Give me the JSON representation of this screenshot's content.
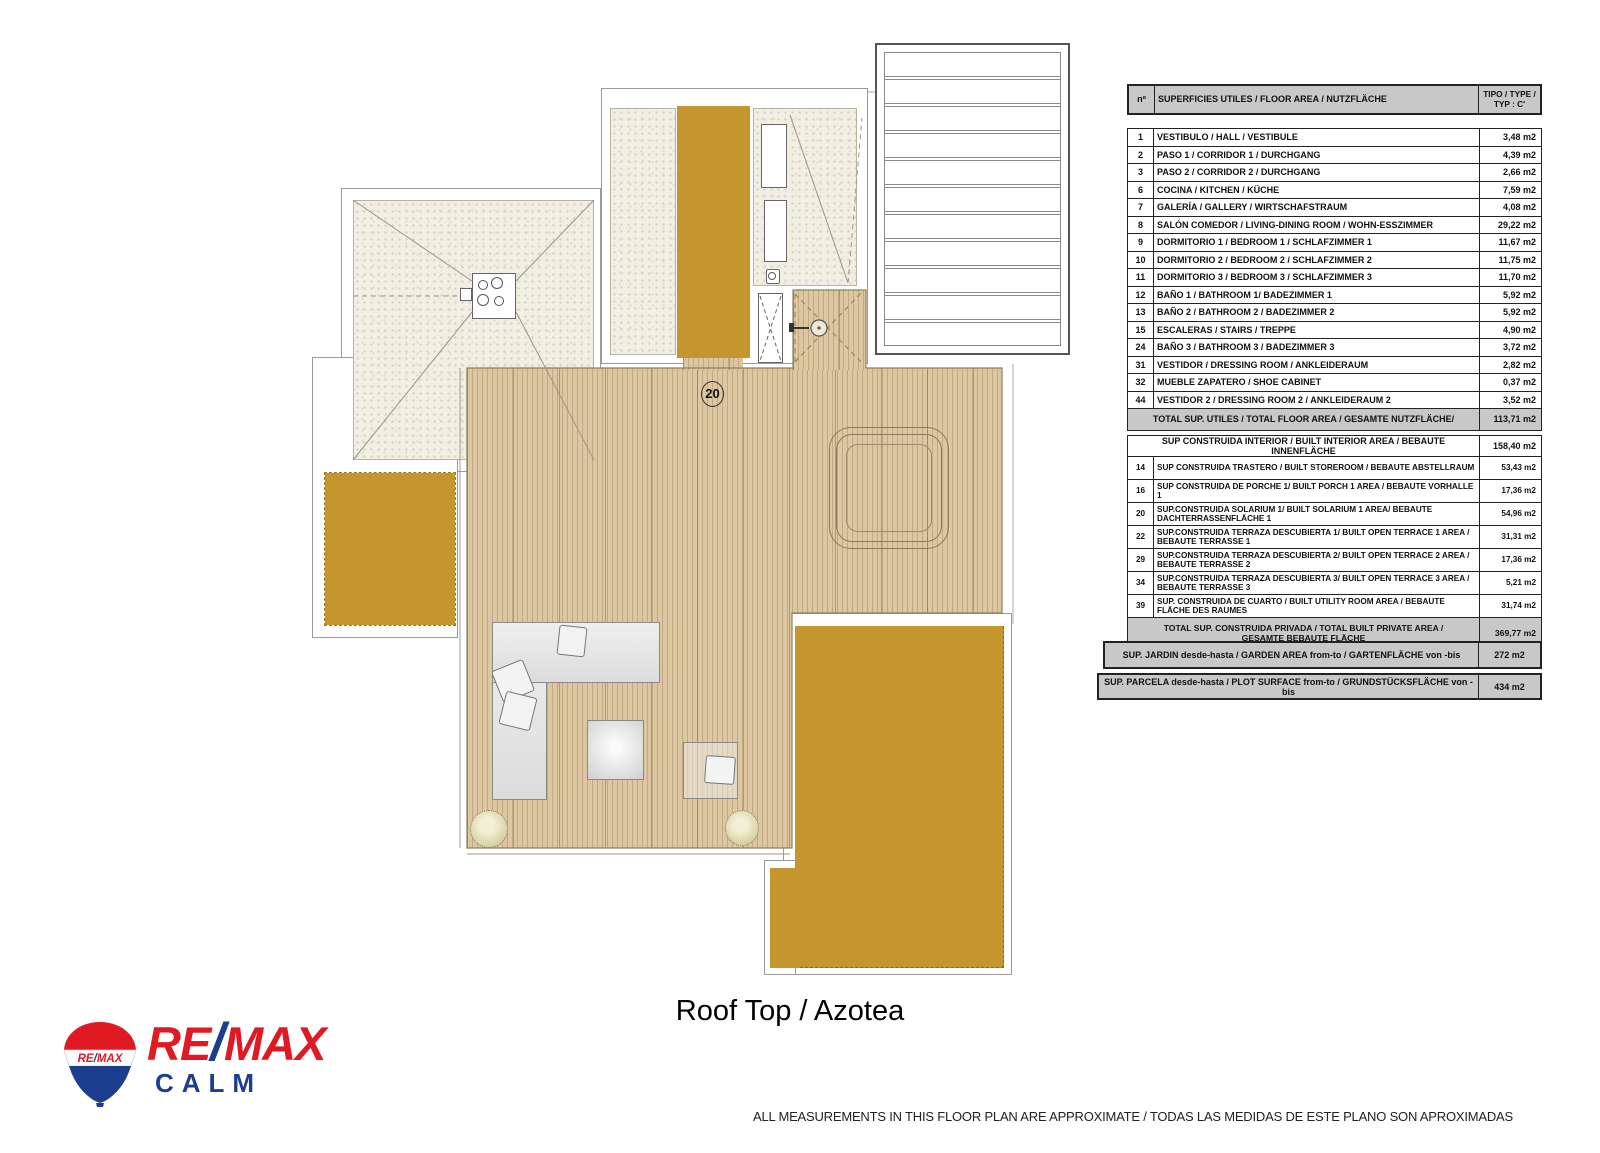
{
  "title": "Roof Top / Azotea",
  "disclaimer": "ALL MEASUREMENTS IN THIS FLOOR PLAN ARE APPROXIMATE / TODAS LAS MEDIDAS DE ESTE PLANO SON APROXIMADAS",
  "logo": {
    "balloon_text": "RE/MAX",
    "re": "RE",
    "slash": "/",
    "max": "MAX",
    "office": "CALM"
  },
  "plan": {
    "solarium_number": "20"
  },
  "colors": {
    "gold": "#c5962e",
    "wood": "#dcc7a2",
    "gravel": "#f1eee3",
    "table_grey": "#c8c8c8",
    "remax_red": "#e01a22",
    "remax_blue": "#1c3e8f"
  },
  "table": {
    "header": {
      "num": "nº",
      "label": "SUPERFICIES UTILES / FLOOR AREA / NUTZFLÄCHE",
      "type": "TIPO / TYPE / TYP : C'"
    },
    "rooms": [
      {
        "num": "1",
        "label": "VESTIBULO / HALL  / VESTIBULE",
        "value": "3,48 m2"
      },
      {
        "num": "2",
        "label": "PASO 1 / CORRIDOR 1 / DURCHGANG",
        "value": "4,39 m2"
      },
      {
        "num": "3",
        "label": "PASO 2 / CORRIDOR 2 / DURCHGANG",
        "value": "2,66 m2"
      },
      {
        "num": "6",
        "label": "COCINA / KITCHEN  / KÜCHE",
        "value": "7,59 m2"
      },
      {
        "num": "7",
        "label": "GALERÍA / GALLERY / WIRTSCHAFSTRAUM",
        "value": "4,08 m2"
      },
      {
        "num": "8",
        "label": "SALÓN COMEDOR  / LIVING-DINING ROOM / WOHN-ESSZIMMER",
        "value": "29,22 m2"
      },
      {
        "num": "9",
        "label": "DORMITORIO 1 / BEDROOM 1 / SCHLAFZIMMER 1",
        "value": "11,67 m2"
      },
      {
        "num": "10",
        "label": "DORMITORIO 2 / BEDROOM 2 / SCHLAFZIMMER 2",
        "value": "11,75 m2"
      },
      {
        "num": "11",
        "label": "DORMITORIO 3 / BEDROOM 3 / SCHLAFZIMMER 3",
        "value": "11,70 m2"
      },
      {
        "num": "12",
        "label": "BAÑO 1 / BATHROOM 1/ BADEZIMMER 1",
        "value": "5,92 m2"
      },
      {
        "num": "13",
        "label": "BAÑO 2 / BATHROOM 2 / BADEZIMMER 2",
        "value": "5,92 m2"
      },
      {
        "num": "15",
        "label": "ESCALERAS / STAIRS / TREPPE",
        "value": "4,90 m2"
      },
      {
        "num": "24",
        "label": "BAÑO 3 / BATHROOM 3 / BADEZIMMER 3",
        "value": "3,72 m2"
      },
      {
        "num": "31",
        "label": "VESTIDOR / DRESSING ROOM / ANKLEIDERAUM",
        "value": "2,82 m2"
      },
      {
        "num": "32",
        "label": "MUEBLE ZAPATERO / SHOE CABINET",
        "value": "0,37 m2"
      },
      {
        "num": "44",
        "label": "VESTIDOR 2 / DRESSING ROOM 2 / ANKLEIDERAUM 2",
        "value": "3,52 m2"
      }
    ],
    "total_utiles": {
      "label": "TOTAL SUP. UTILES / TOTAL FLOOR AREA  / GESAMTE NUTZFLÄCHE/",
      "value": "113,71 m2"
    },
    "built_interior": {
      "label": "SUP CONSTRUIDA INTERIOR / BUILT INTERIOR AREA / BEBAUTE INNENFLÄCHE",
      "value": "158,40 m2"
    },
    "built_rows": [
      {
        "num": "14",
        "label": "SUP CONSTRUIDA TRASTERO / BUILT STOREROOM / BEBAUTE ABSTELLRAUM",
        "value": "53,43 m2"
      },
      {
        "num": "16",
        "label": "SUP CONSTRUIDA  DE PORCHE 1/ BUILT PORCH 1 AREA  / BEBAUTE VORHALLE 1",
        "value": "17,36 m2"
      },
      {
        "num": "20",
        "label": "SUP.CONSTRUIDA SOLARIUM 1/ BUILT SOLARIUM 1 AREA/  BEBAUTE DACHTERRASSENFLÄCHE 1",
        "value": "54,96 m2"
      },
      {
        "num": "22",
        "label": "SUP.CONSTRUIDA TERRAZA DESCUBIERTA 1/ BUILT OPEN TERRACE 1 AREA / BEBAUTE TERRASSE 1",
        "value": "31,31 m2"
      },
      {
        "num": "29",
        "label": "SUP.CONSTRUIDA TERRAZA DESCUBIERTA 2/ BUILT OPEN TERRACE 2 AREA / BEBAUTE TERRASSE 2",
        "value": "17,36 m2"
      },
      {
        "num": "34",
        "label": "SUP.CONSTRUIDA TERRAZA DESCUBIERTA 3/ BUILT OPEN TERRACE 3 AREA / BEBAUTE TERRASSE 3",
        "value": "5,21 m2"
      },
      {
        "num": "39",
        "label": "SUP. CONSTRUIDA DE CUARTO / BUILT UTILITY ROOM AREA / BEBAUTE FLÄCHE DES RAUMES",
        "value": "31,74 m2"
      }
    ],
    "total_privada": {
      "label": "TOTAL SUP. CONSTRUIDA PRIVADA / TOTAL  BUILT PRIVATE AREA / GESAMTE BEBAUTE FLÄCHE",
      "value": "369,77 m2"
    },
    "jardin": {
      "label": "SUP. JARDIN desde-hasta / GARDEN AREA from-to  /  GARTENFLÄCHE von -bis",
      "value": "272 m2"
    },
    "parcela": {
      "label": "SUP. PARCELA desde-hasta / PLOT SURFACE from-to  / GRUNDSTÜCKSFLÄCHE von -bis",
      "value": "434 m2"
    }
  }
}
